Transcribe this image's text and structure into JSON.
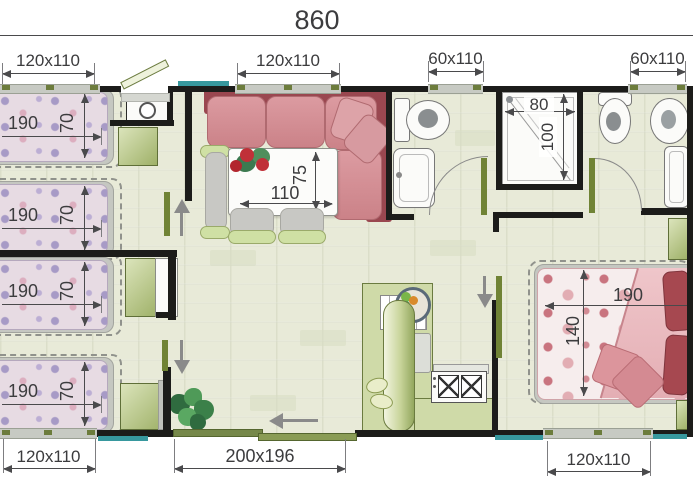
{
  "plan": {
    "overall_width": "860",
    "windows": {
      "top_left": "120x110",
      "top_center": "120x110",
      "bathroom_1": "60x110",
      "bathroom_2": "60x110",
      "bottom_left": "120x110",
      "bottom_right": "120x110"
    },
    "patio_door": "200x196",
    "beds": {
      "bed_1": {
        "length": "190",
        "width": "70"
      },
      "bed_2": {
        "length": "190",
        "width": "70"
      },
      "bed_3": {
        "length": "190",
        "width": "70"
      },
      "bed_4": {
        "length": "190",
        "width": "70"
      },
      "double_bed": {
        "length": "190",
        "width": "140"
      }
    },
    "dining_table": {
      "length": "110",
      "width": "75"
    },
    "shower": {
      "width": "80",
      "depth": "100"
    }
  },
  "colors": {
    "wall": "#1c1c1a",
    "floor": "#e8ead8",
    "sofa_frame": "#9a4750",
    "sofa_cushion": "#d18d93",
    "single_bed_fabric": "#e7dbe3",
    "double_bed_motif": "#c9747f",
    "cabinet_green": "#a8b974",
    "window_glass": "#37989e",
    "door_panel": "#708335",
    "dimension_text": "#3c3c3e"
  }
}
